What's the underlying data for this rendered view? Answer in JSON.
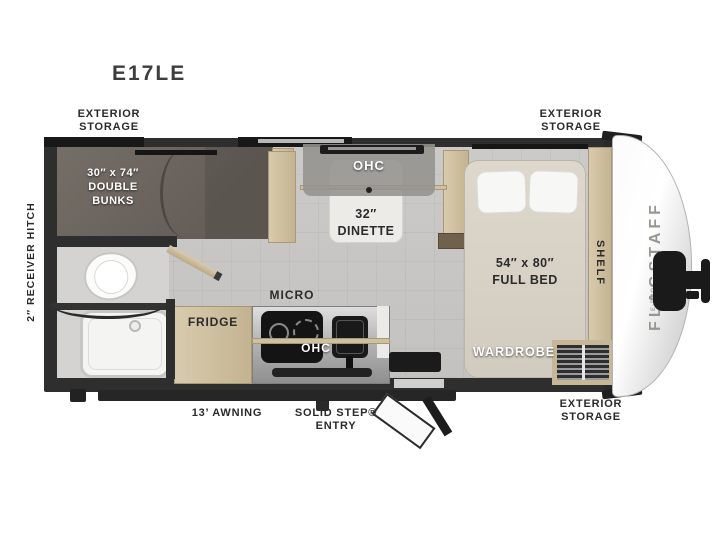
{
  "model": "E17LE",
  "callouts": {
    "storage_tl_1": "EXTERIOR",
    "storage_tl_2": "STORAGE",
    "storage_tr_1": "EXTERIOR",
    "storage_tr_2": "STORAGE",
    "storage_br_1": "EXTERIOR",
    "storage_br_2": "STORAGE",
    "receiver_hitch": "2″ RECEIVER HITCH",
    "awning": "13’ AWNING",
    "entry_1": "SOLID STEP®",
    "entry_2": "ENTRY"
  },
  "rooms": {
    "bunks_1": "30″ x 74″",
    "bunks_2": "DOUBLE",
    "bunks_3": "BUNKS",
    "dinette_ohc": "OHC",
    "dinette_1": "32″",
    "dinette_2": "DINETTE",
    "micro": "MICRO",
    "fridge": "FRIDGE",
    "kitchen_ohc": "OHC",
    "bed_1": "54″ x 80″",
    "bed_2": "FULL BED",
    "wardrobe": "WARDROBE",
    "shelf": "SHELF"
  },
  "brand": {
    "name": "FLAGSTAFF",
    "sub": "E-PRO"
  },
  "colors": {
    "wall": "#2e2e2e",
    "floor": "#c7c6c4",
    "wood_cabinet": "#cfc0a1",
    "bunk_carpet": "#6e6862",
    "bed_mattress": "#d8d2c7",
    "counter": "#b5b5b5",
    "appliance_dark": "#1a1a1a",
    "front_cap": "#f2f2f2",
    "label_text": "#2b2b2b"
  }
}
